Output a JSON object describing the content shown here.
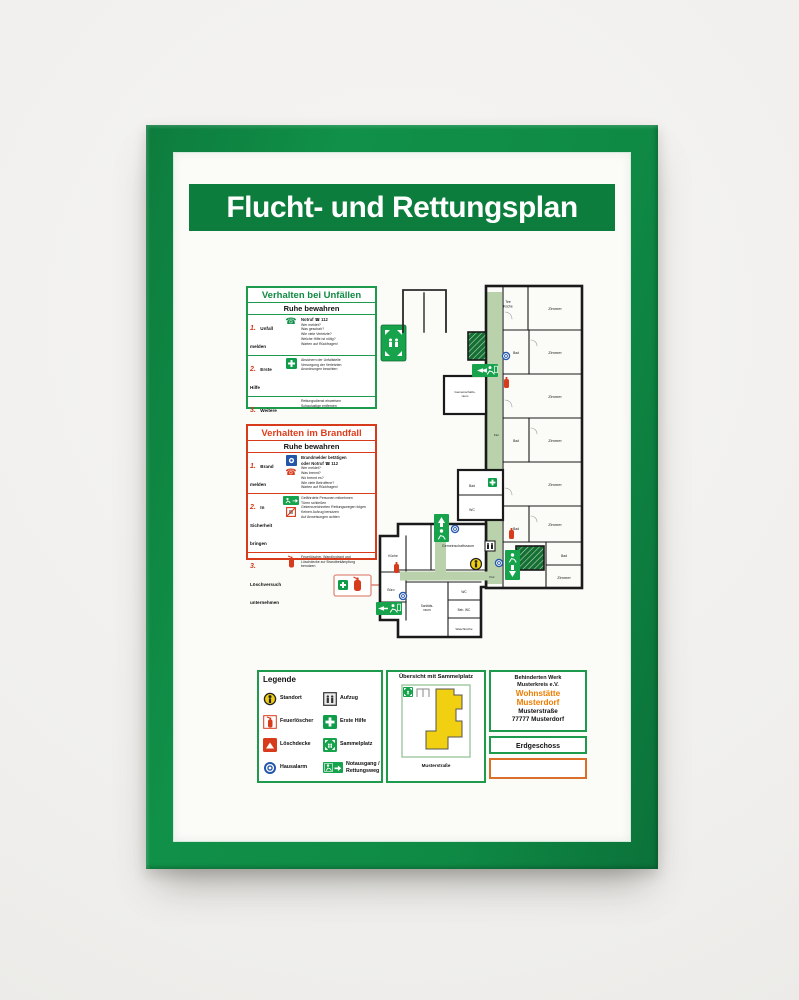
{
  "title_banner": {
    "text": "Flucht- und Rettungsplan"
  },
  "accident_panel": {
    "title": "Verhalten bei Unfällen",
    "subtitle": "Ruhe bewahren",
    "rows": [
      {
        "num": "1.",
        "label": "Unfall melden",
        "bold": "Notruf ☎ 112",
        "lines": [
          "Wer meldet?",
          "Was geschah?",
          "Wie viele Verletzte?",
          "Welche Hilfe ist nötig?",
          "Warten auf Rückfragen!"
        ]
      },
      {
        "num": "2.",
        "label": "Erste Hilfe",
        "lines": [
          "Absichern der Unfallstelle",
          "Versorgung der Verletzten",
          "Anordnungen beachten"
        ]
      },
      {
        "num": "3.",
        "label": "Weitere Maßnahmen",
        "lines": [
          "Rettungsdienst einweisen",
          "Schaulustige entfernen"
        ]
      }
    ]
  },
  "fire_panel": {
    "title": "Verhalten im Brandfall",
    "subtitle": "Ruhe bewahren",
    "rows": [
      {
        "num": "1.",
        "label": "Brand melden",
        "lines": [
          "Brandmelder betätigen",
          "oder Notruf ☎ 112",
          "Wer meldet?",
          "Was brennt?",
          "Wo brennt es?",
          "Wie viele Betroffene?",
          "Warten auf Rückfragen!"
        ]
      },
      {
        "num": "2.",
        "label": "In Sicherheit bringen",
        "lines": [
          "Gefährdete Personen mitnehmen",
          "Türen schließen",
          "Gekennzeichneten Rettungswegen folgen",
          "Keinen Aufzug benutzen",
          "Auf Anweisungen achten"
        ]
      },
      {
        "num": "3.",
        "label": "Löschversuch unternehmen",
        "lines": [
          "Feuerlöscher, Wandhydrant und Löschdecke zur Brandbekämpfung benutzen"
        ]
      }
    ]
  },
  "plan": {
    "labels": {
      "tee1": "Tee",
      "tee2": "Küche",
      "zimmer": "Zimmer",
      "bad": "Bad",
      "flur": "Flur",
      "wc": "WC",
      "gem1a": "Gemeinschafts-",
      "gem1b": "raum",
      "gemeinschaftsraum": "Gemeinschaftsraum",
      "kueche": "Küche",
      "buero": "Büro",
      "sanitaets1": "Sanitäts-",
      "sanitaets2": "raum",
      "behwc": "Beh. WC",
      "waschkueche": "Waschküche"
    }
  },
  "legend": {
    "title": "Legende",
    "items": {
      "standort": "Standort",
      "feuerloescher": "Feuerlöscher",
      "loeschdecke": "Löschdecke",
      "hausalarm": "Hausalarm",
      "aufzug": "Aufzug",
      "erste_hilfe": "Erste Hilfe",
      "sammelplatz": "Sammelplatz",
      "notausgang1": "Notausgang /",
      "notausgang2": "Rettungsweg"
    }
  },
  "overview": {
    "title": "Übersicht mit Sammelplatz",
    "street": "Musterstraße"
  },
  "address": {
    "org1": "Behinderten Werk",
    "org2": "Musterkreis e.V.",
    "name1": "Wohnstätte",
    "name2": "Musterdorf",
    "street": "Musterstraße",
    "city": "77777 Musterdorf",
    "floor": "Erdgeschoss"
  },
  "colors": {
    "frame_green": "#0f8a45",
    "banner_green": "#0c7d3c",
    "sign_green": "#17a24c",
    "stairs_green": "#156f33",
    "route_green": "#b9d2ab",
    "alarm_blue": "#2456aa",
    "alert_red": "#d83a1c",
    "standort_yellow": "#f2cf0e",
    "accent_orange": "#ee7d00"
  }
}
